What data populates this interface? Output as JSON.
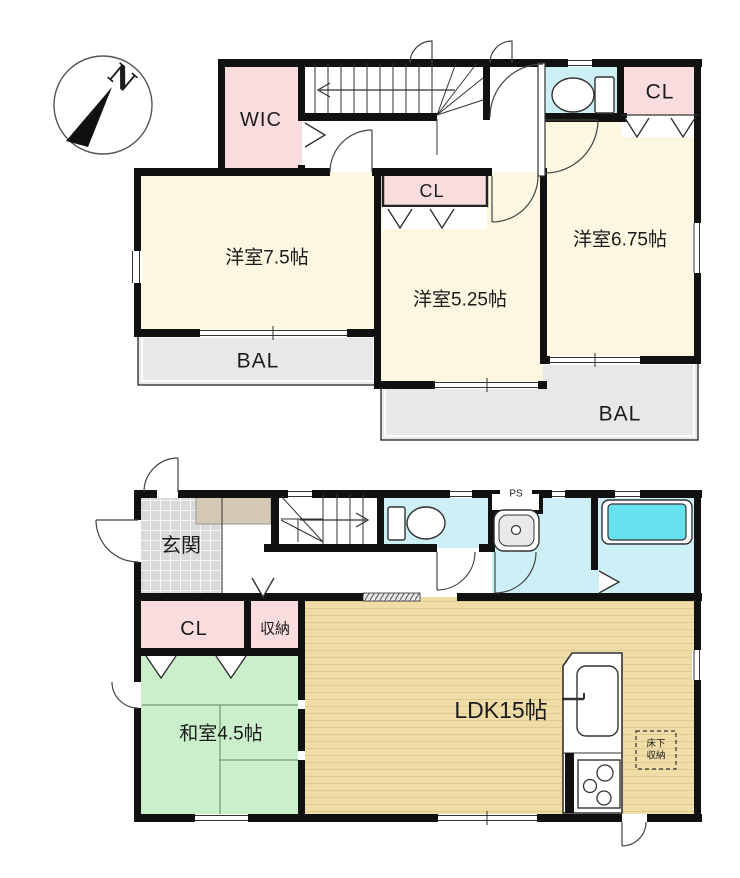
{
  "compass": {
    "north_label": "N"
  },
  "floor2": {
    "rooms": {
      "wic": "WIC",
      "closet_right": "CL",
      "closet_mid": "CL",
      "bedroom_75": "洋室7.5帖",
      "bedroom_525": "洋室5.25帖",
      "bedroom_675": "洋室6.75帖",
      "balcony_left": "BAL",
      "balcony_right": "BAL"
    }
  },
  "floor1": {
    "rooms": {
      "entrance": "玄関",
      "pipe_space": "PS",
      "closet": "CL",
      "storage": "収納",
      "japanese_room": "和室4.5帖",
      "ldk": "LDK15帖",
      "underfloor_storage_line1": "床下",
      "underfloor_storage_line2": "収納"
    }
  },
  "colors": {
    "wall": "#111111",
    "room_cream": "#FBF7E0",
    "closet_pink": "#F8DCDE",
    "wet_cyan": "#CDEFF6",
    "tub_cyan": "#66E2EE",
    "tatami_green": "#CBEECB",
    "wood_tan": "#F0DCA6",
    "wood_stripe": "#DECB92",
    "balcony_gray": "#E8E8E8",
    "tile_gray": "#D9D9D9",
    "cabinet_tan": "#D5C8B4"
  }
}
